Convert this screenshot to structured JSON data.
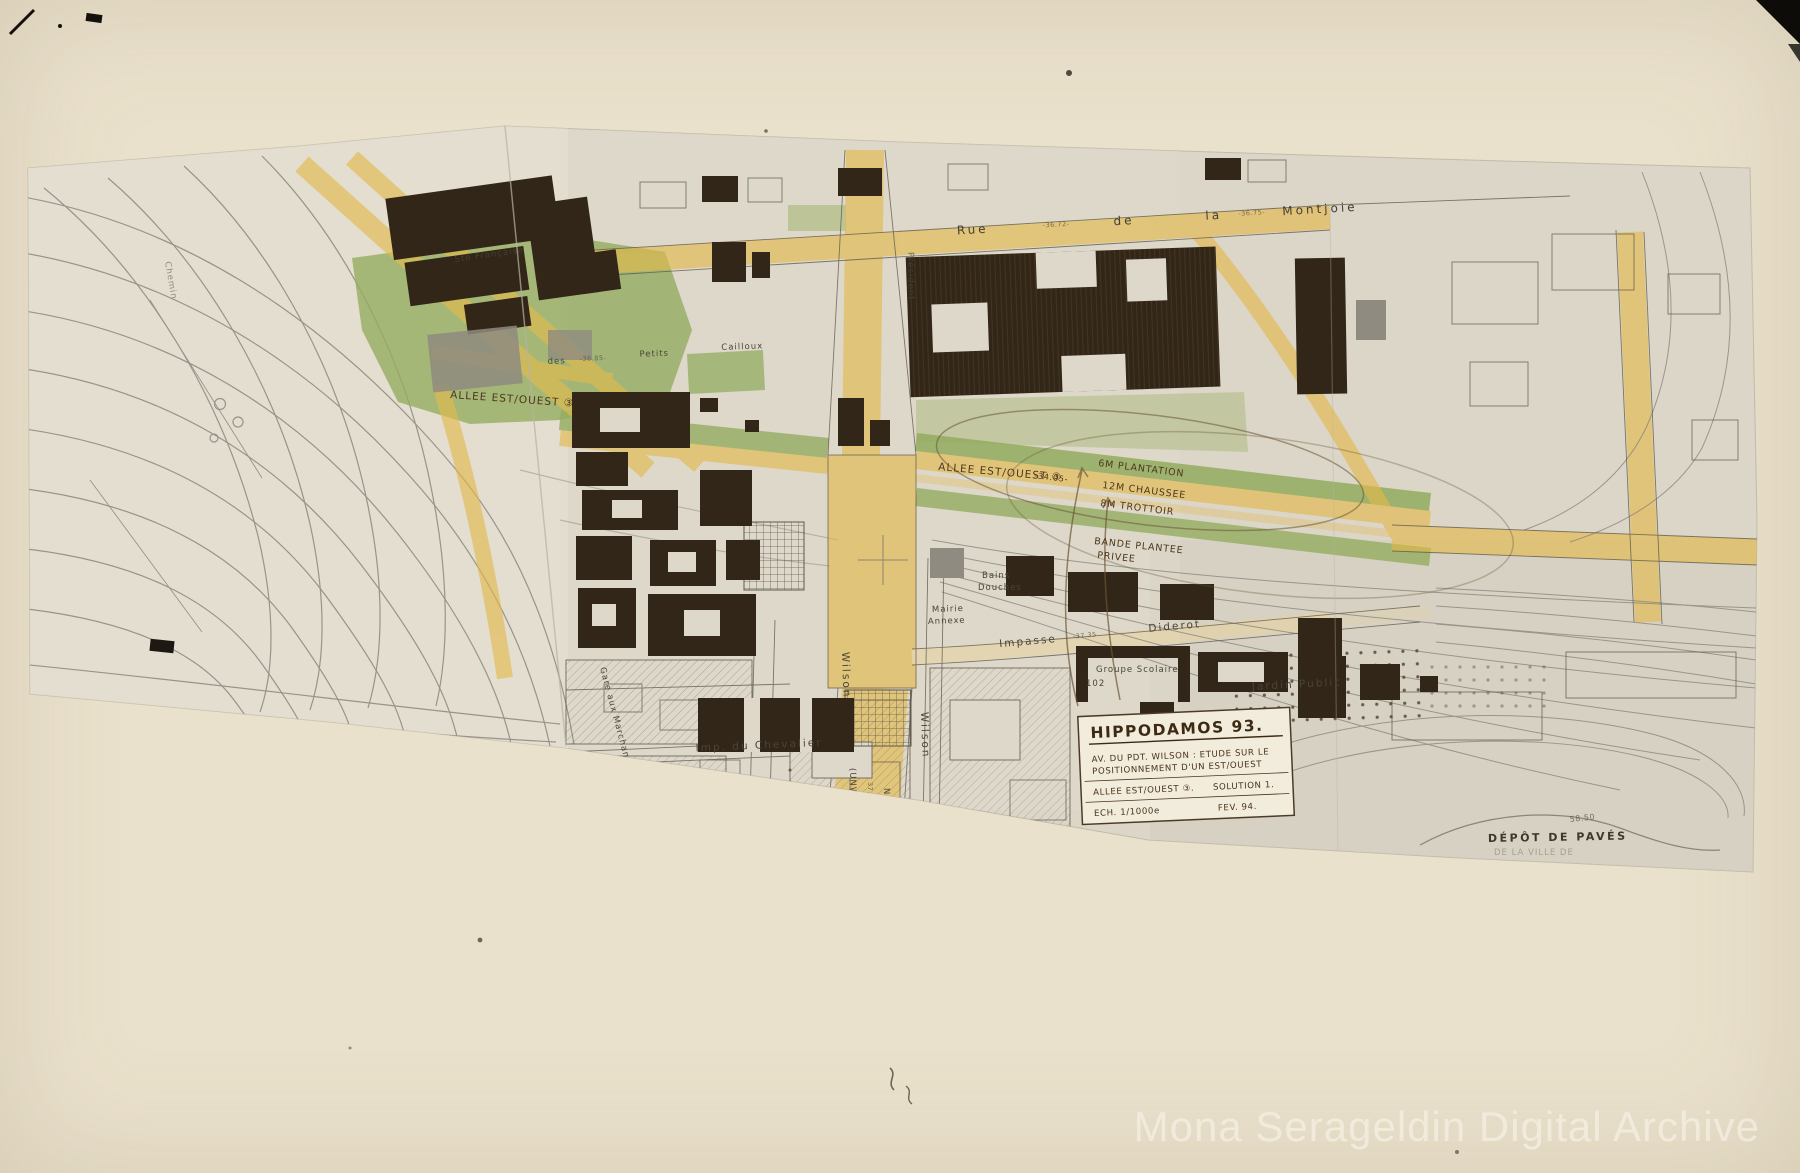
{
  "watermark": "Mona Serageldin Digital Archive",
  "card": {
    "title": "HIPPODAMOS 93.",
    "line1": "AV. DU PDT. WILSON : ETUDE SUR LE",
    "line2": "POSITIONNEMENT D'UN EST/OUEST",
    "row2_left": "ALLEE EST/OUEST ③.",
    "row2_right": "SOLUTION 1.",
    "row3_left": "ECH. 1/1000e",
    "row3_right": "FEV. 94."
  },
  "handwritten": {
    "allee_left": "ALLEE EST/OUEST ③",
    "allee_mid": "ALLEE EST/OUEST ③",
    "strip_line1": "6M PLANTATION",
    "strip_line2": "12M CHAUSSEE",
    "strip_line3": "8M TROTTOIR",
    "bande_line1": "BANDE PLANTEE",
    "bande_line2": "PRIVEE",
    "num_3405": "-34.05-"
  },
  "streets": {
    "rue": "Rue",
    "de": "de",
    "la": "la",
    "montjoie": "Montjoie",
    "impasse": "Impasse",
    "diderot": "Diderot",
    "imp_chevalier": "Imp. du Chevalier",
    "wilson": "Wilson",
    "unwin": "(UNWIN)",
    "nde": "N.De",
    "president": "Président",
    "des": "des",
    "petits": "Petits",
    "cailloux": "Cailloux",
    "gare_marchandises": "Gare aux Marchandises",
    "chemin": "Chemin"
  },
  "places": {
    "mairie_l1": "Mairie",
    "mairie_l2": "Annexe",
    "groupe_l1": "Groupe Scolaire",
    "groupe_l2": "102",
    "jardin": "Jardin Public",
    "depot_l1": "DÉPÔT DE PAVÉS",
    "depot_l2": "DE LA VILLE DE",
    "bains_l1": "Bains",
    "bains_l2": "Douches",
    "factory": "Sté Française"
  },
  "elevations": {
    "e1": "-36.85-",
    "e2": "-37.35",
    "e3": "58.50",
    "e4": "-37.25-",
    "e5": "37.10",
    "e6": "-36.72-",
    "e7": "-36.75-"
  }
}
